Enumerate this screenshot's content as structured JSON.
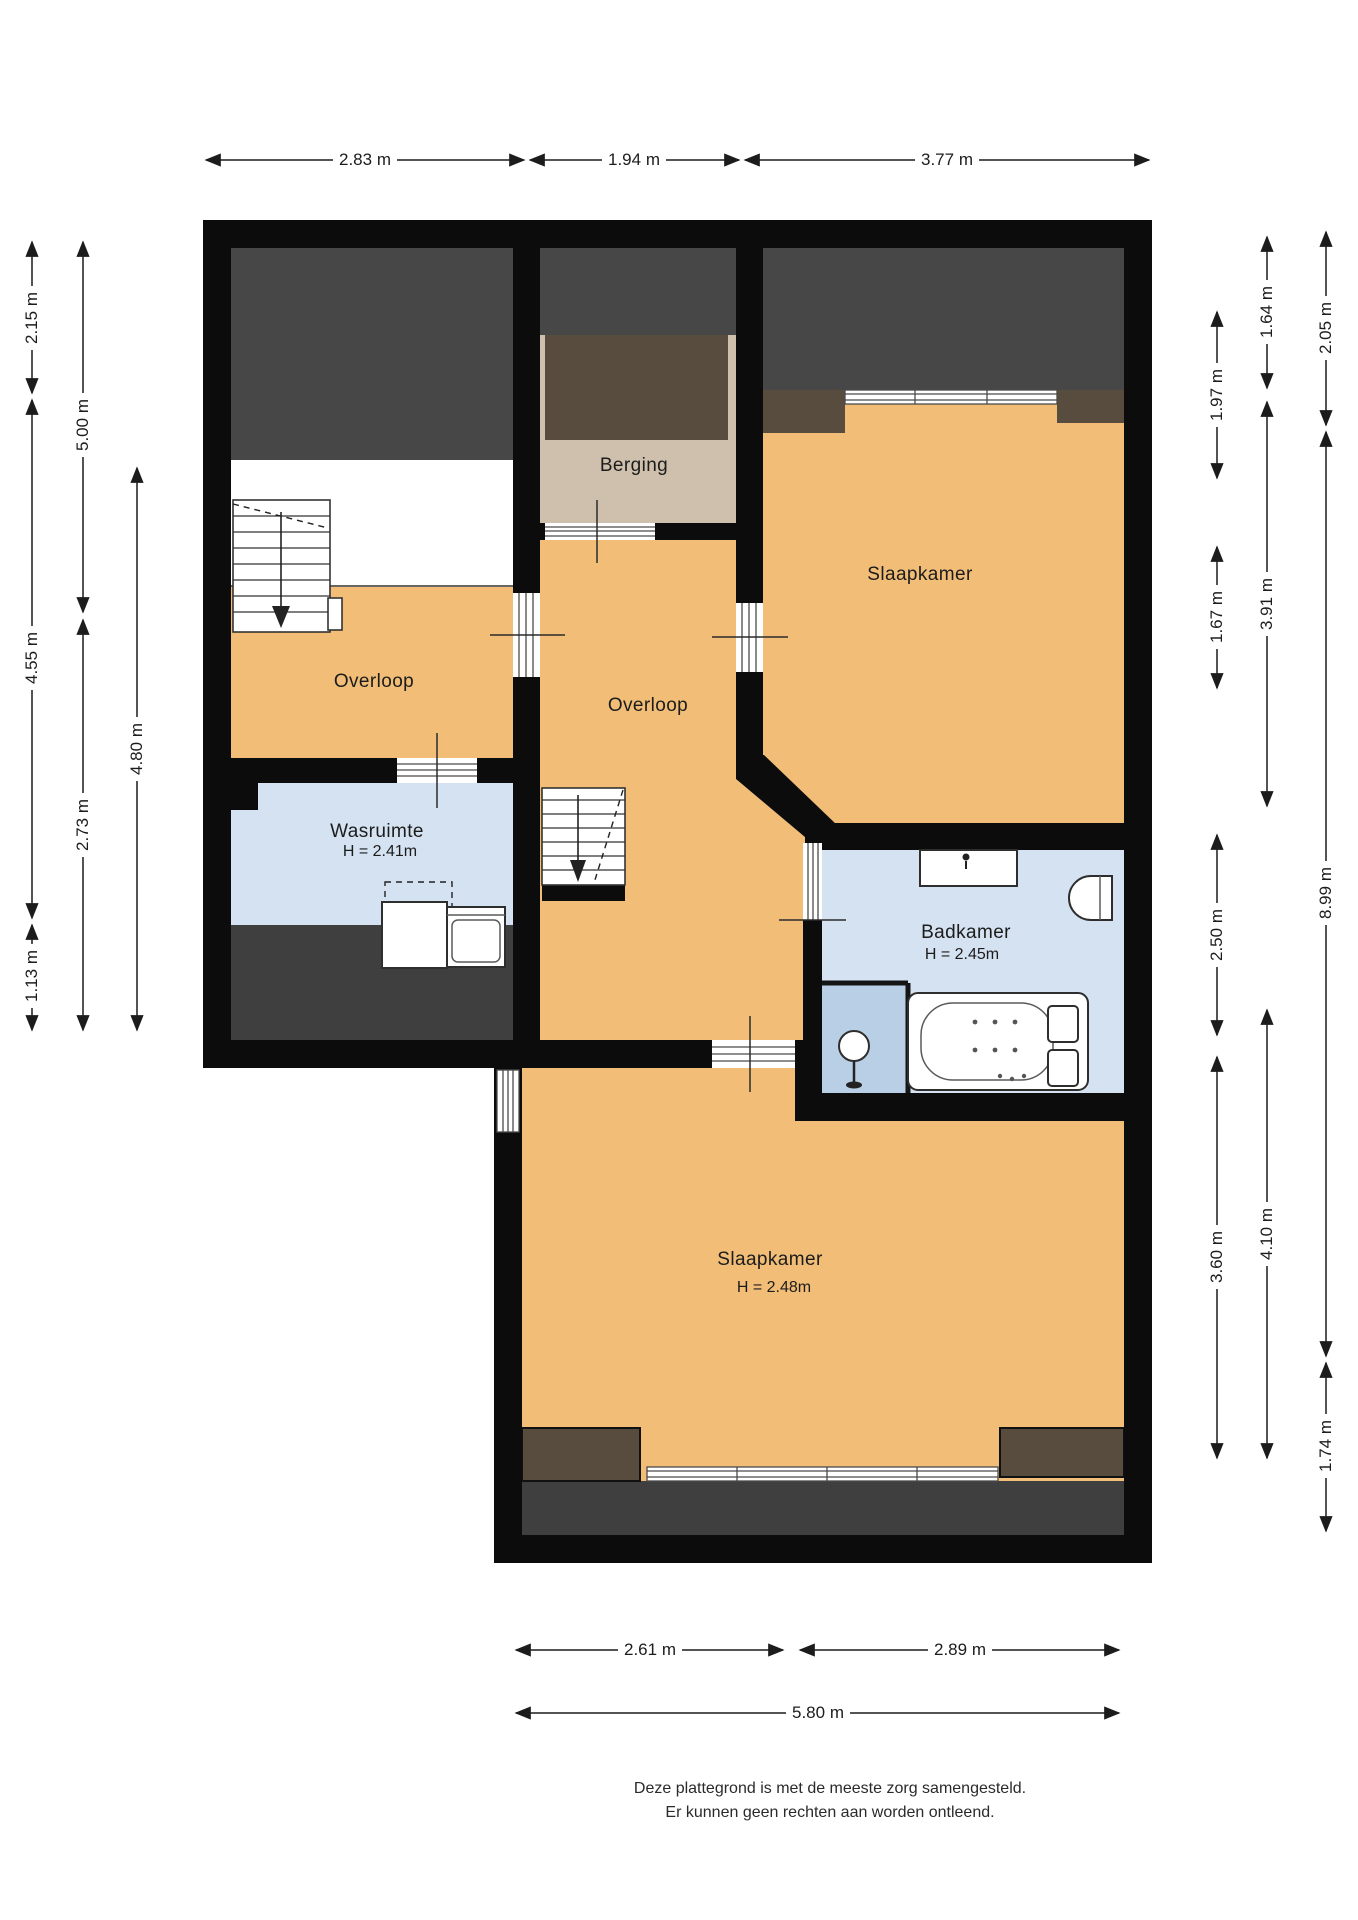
{
  "plan": {
    "rooms": {
      "berging": {
        "label": "Berging"
      },
      "overloop_links": {
        "label": "Overloop"
      },
      "overloop_midden": {
        "label": "Overloop"
      },
      "wasruimte": {
        "label": "Wasruimte",
        "height": "H = 2.41m"
      },
      "slaapkamer_boven": {
        "label": "Slaapkamer"
      },
      "badkamer": {
        "label": "Badkamer",
        "height": "H = 2.45m"
      },
      "slaapkamer_beneden": {
        "label": "Slaapkamer",
        "height": "H = 2.48m"
      }
    },
    "dimensions": {
      "top": [
        "2.83 m",
        "1.94 m",
        "3.77 m"
      ],
      "bottom": [
        "2.61 m",
        "2.89 m",
        "5.80 m"
      ],
      "left": [
        "2.15 m",
        "5.00 m",
        "4.55 m",
        "4.80 m",
        "2.73 m",
        "1.13 m"
      ],
      "right": [
        "1.64 m",
        "2.05 m",
        "1.97 m",
        "3.91 m",
        "1.67 m",
        "8.99 m",
        "2.50 m",
        "3.60 m",
        "4.10 m",
        "1.74 m"
      ]
    }
  },
  "footer": {
    "line1": "Deze plattegrond is met de meeste zorg samengesteld.",
    "line2": "Er kunnen geen rechten aan worden ontleend."
  },
  "colors": {
    "wall": "#0c0c0c",
    "floor": "#f1bd77",
    "wet": "#d5e2f1",
    "shower": "#b9cfe6",
    "roof": "#474747",
    "band": "#3f3f3f",
    "beige": "#cec0ac",
    "dormer": "#584c3e",
    "bg": "#ffffff"
  }
}
